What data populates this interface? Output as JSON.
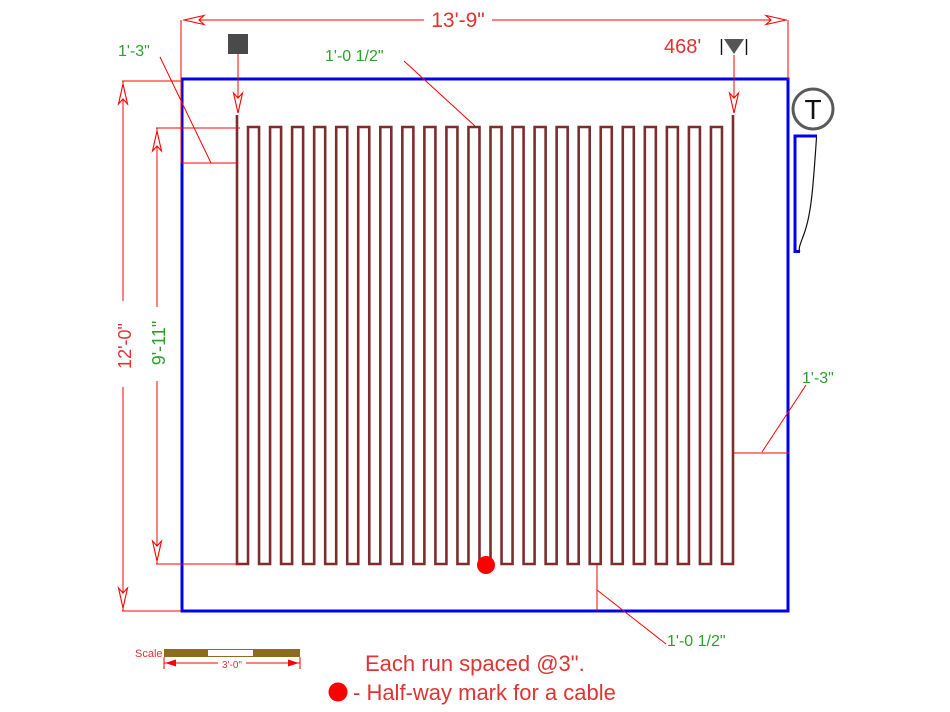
{
  "drawing": {
    "title_hint": "electric heating cable floor layout",
    "dimensions": {
      "width": "13'-9\"",
      "height": "12'-0\"",
      "cable_height": "9'-11\""
    },
    "offsets": {
      "left": "1'-3\"",
      "right": "1'-3\"",
      "top_loop": "1'-0 1/2\"",
      "bottom_loop": "1'-0 1/2\""
    },
    "cable": {
      "length": "468'"
    },
    "thermostat_label": "T",
    "notes": {
      "line1": "Each run spaced @3\".",
      "line2": "- Half-way mark for a cable"
    },
    "scale": {
      "label": "Scale",
      "value": "3'-0\""
    },
    "colors": {
      "wall": "#0000F0",
      "cable": "#7E2D2D",
      "dimension": "#FF0000",
      "red_text": "#E03232",
      "green_text": "#2F9E2F",
      "marker_gray": "#4A4A4A",
      "scale_bar": "#8A6D20",
      "halfway_dot": "#FF0000"
    },
    "serpentine": {
      "x_start": 237,
      "x_end": 733,
      "y_top": 127,
      "y_bottom": 564,
      "tip_y": 115,
      "runs": 46
    }
  }
}
